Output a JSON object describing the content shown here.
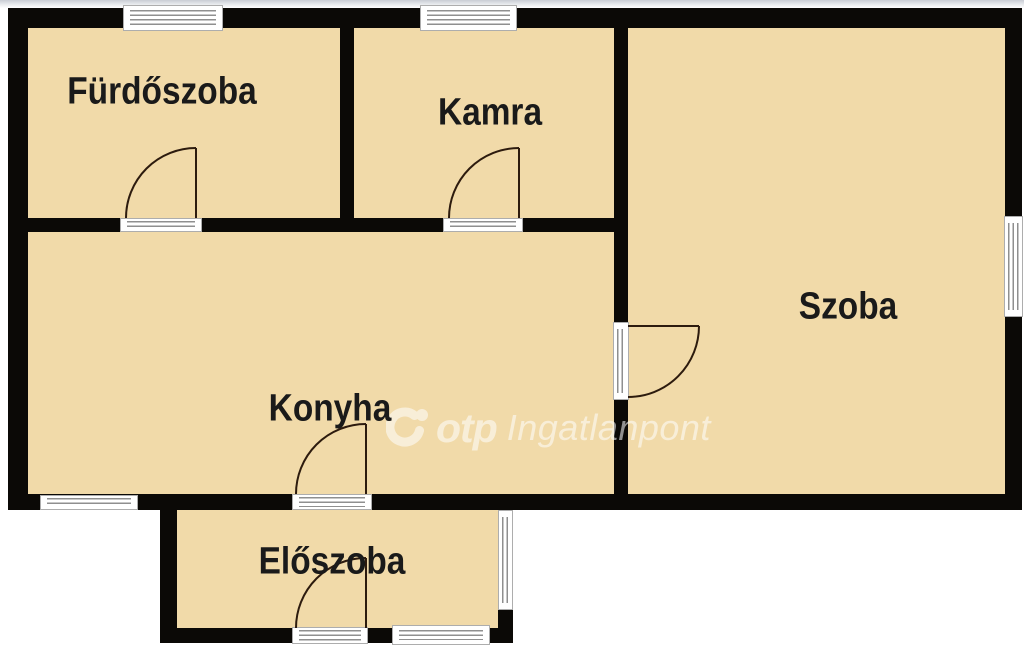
{
  "plan": {
    "rooms": [
      {
        "name": "furdoszoba",
        "label": "Fürdőszoba"
      },
      {
        "name": "kamra",
        "label": "Kamra"
      },
      {
        "name": "szoba",
        "label": "Szoba"
      },
      {
        "name": "konyha",
        "label": "Konyha"
      },
      {
        "name": "eloszoba",
        "label": "Előszoba"
      }
    ]
  },
  "watermark": {
    "brand": "otp",
    "suffix": "Ingatlanpont"
  },
  "colors": {
    "room_fill": "#f1daa9",
    "wall": "#0b0906",
    "label_text": "#1a1a1a",
    "window_line": "#8f8f8f",
    "door_arc": "#2d1b0e",
    "watermark_text": "#ffffff"
  }
}
